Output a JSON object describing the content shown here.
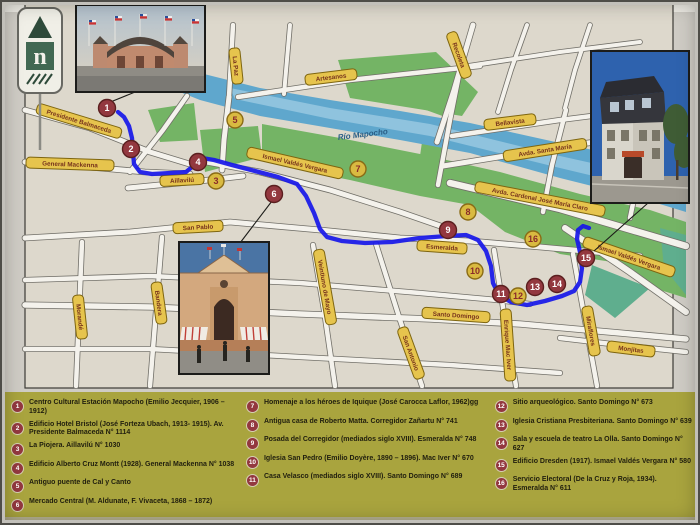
{
  "title": "Mapa turístico del centro de Santiago - ruta patrimonial",
  "logo": {
    "letter": "n"
  },
  "colors": {
    "route_blue": "#1818e8",
    "river_blue": "#5fa7cd",
    "river_light": "#8fc3de",
    "park_green": "#74b465",
    "teal_green": "#5fae8e",
    "label_fill": "#e6c44d",
    "label_border": "#7e650f",
    "label_text": "#77331c",
    "marker_red": "#93383f",
    "marker_yellow": "#d9ba41",
    "legend_bg": "#a9a43e",
    "paper": "#ddd8cc",
    "street": "#f4f2ec"
  },
  "map": {
    "river_label": {
      "text": "Río Mapocho",
      "x": 363,
      "y": 137,
      "rot": -7
    },
    "street_labels": [
      {
        "text": "Presidente Balmaceda",
        "x": 79,
        "y": 121,
        "rot": 17,
        "w": 88
      },
      {
        "text": "General Mackenna",
        "x": 70,
        "y": 164,
        "rot": 2,
        "w": 88
      },
      {
        "text": "Aillavilú",
        "x": 182,
        "y": 180,
        "rot": -3,
        "w": 44
      },
      {
        "text": "La Paz",
        "x": 236,
        "y": 66,
        "rot": 84,
        "w": 36
      },
      {
        "text": "Artesanos",
        "x": 331,
        "y": 77,
        "rot": -7,
        "w": 52
      },
      {
        "text": "Recoleta",
        "x": 459,
        "y": 55,
        "rot": 70,
        "w": 48
      },
      {
        "text": "Bellavista",
        "x": 510,
        "y": 122,
        "rot": -7,
        "w": 52
      },
      {
        "text": "Avda. Santa María",
        "x": 545,
        "y": 150,
        "rot": -9,
        "w": 84
      },
      {
        "text": "Ismael Valdés Vergara",
        "x": 295,
        "y": 163,
        "rot": 13,
        "w": 98
      },
      {
        "text": "Avda. Cardenal José María Claro",
        "x": 540,
        "y": 199,
        "rot": 11,
        "w": 132
      },
      {
        "text": "Esmeralda",
        "x": 442,
        "y": 247,
        "rot": 4,
        "w": 50
      },
      {
        "text": "Ismael Valdés Vergara",
        "x": 629,
        "y": 257,
        "rot": 19,
        "w": 96
      },
      {
        "text": "Santo Domingo",
        "x": 456,
        "y": 315,
        "rot": 4,
        "w": 68
      },
      {
        "text": "Monjitas",
        "x": 631,
        "y": 349,
        "rot": 7,
        "w": 48
      },
      {
        "text": "San Pablo",
        "x": 198,
        "y": 227,
        "rot": -3,
        "w": 50
      },
      {
        "text": "Morandé",
        "x": 80,
        "y": 317,
        "rot": 84,
        "w": 44
      },
      {
        "text": "Bandera",
        "x": 159,
        "y": 303,
        "rot": 82,
        "w": 42
      },
      {
        "text": "Veintiuno de Mayo",
        "x": 325,
        "y": 287,
        "rot": 80,
        "w": 76
      },
      {
        "text": "San Antonio",
        "x": 411,
        "y": 353,
        "rot": 70,
        "w": 54
      },
      {
        "text": "Enrique Mac Iver",
        "x": 508,
        "y": 345,
        "rot": 86,
        "w": 72
      },
      {
        "text": "Miraflores",
        "x": 591,
        "y": 331,
        "rot": 80,
        "w": 50
      }
    ],
    "streets": [
      {
        "pts": "25,110 90,128 150,152 196,166",
        "w": 5
      },
      {
        "pts": "25,162 100,168 145,172 190,174",
        "w": 5
      },
      {
        "pts": "128,188 200,181 243,176",
        "w": 5
      },
      {
        "pts": "130,172 163,130 187,96",
        "w": 4.5
      },
      {
        "pts": "25,238 130,232 230,222 320,230 400,238 470,241 540,247 640,256",
        "w": 5
      },
      {
        "pts": "25,280 150,276 300,283 420,293 497,300 530,304",
        "w": 4.5
      },
      {
        "pts": "25,305 150,307 300,314 430,319 520,324 620,333 686,339",
        "w": 5.5
      },
      {
        "pts": "560,338 620,345 686,352",
        "w": 4.5
      },
      {
        "pts": "25,349 150,349 300,357 450,365 560,373",
        "w": 4.5
      },
      {
        "pts": "82,242 76,386",
        "w": 4.5
      },
      {
        "pts": "162,237 150,386",
        "w": 4.5
      },
      {
        "pts": "313,245 324,310 335,386",
        "w": 4.5
      },
      {
        "pts": "376,244 400,320 422,386",
        "w": 4.5
      },
      {
        "pts": "494,250 505,320 516,386",
        "w": 4.5
      },
      {
        "pts": "573,254 585,320 597,386",
        "w": 4.5
      },
      {
        "pts": "196,160 260,172 330,190 400,212 452,230",
        "w": 5
      },
      {
        "pts": "565,228 630,272 686,312",
        "w": 6
      },
      {
        "pts": "450,183 560,209 686,246",
        "w": 6.5
      },
      {
        "pts": "238,97 350,80 480,66",
        "w": 4.5
      },
      {
        "pts": "233,25 229,97",
        "w": 4.5
      },
      {
        "pts": "229,97 224,140 222,170",
        "w": 5
      },
      {
        "pts": "290,25 284,94",
        "w": 4
      },
      {
        "pts": "462,60 450,120 438,185",
        "w": 4.5
      },
      {
        "pts": "473,25 454,90 437,142",
        "w": 5
      },
      {
        "pts": "452,136 560,120 686,104",
        "w": 4.5
      },
      {
        "pts": "443,166 560,147 686,129",
        "w": 5
      },
      {
        "pts": "566,110 552,165 543,212",
        "w": 4.5
      },
      {
        "pts": "655,113 640,170 630,218",
        "w": 4.5
      },
      {
        "pts": "527,25 511,70 498,112",
        "w": 4
      },
      {
        "pts": "590,25 575,70 565,108",
        "w": 4
      },
      {
        "pts": "468,66 560,52 640,42",
        "w": 4
      }
    ],
    "route_points": "118,112 124,117 129,126 132,138 133,152 134,164 140,172 152,174 170,173 186,172 192,167 195,160 202,158 214,160 232,165 255,171 278,177 297,184 306,196 314,213 320,229 327,237 342,241 365,243 392,242 420,238 447,236 466,235 478,240 486,251 491,266 493,283 499,295 511,302 527,305 545,301 562,296 574,291 580,282 582,268 580,252 577,239 578,230 583,226 589,228",
    "connectors": [
      {
        "x1": 108,
        "y1": 103,
        "x2": 140,
        "y2": 90
      },
      {
        "x1": 272,
        "y1": 201,
        "x2": 240,
        "y2": 243
      },
      {
        "x1": 648,
        "y1": 203,
        "x2": 594,
        "y2": 251
      }
    ],
    "markers": [
      {
        "num": "1",
        "x": 107,
        "y": 108,
        "type": "red"
      },
      {
        "num": "2",
        "x": 131,
        "y": 149,
        "type": "red"
      },
      {
        "num": "3",
        "x": 216,
        "y": 181,
        "type": "yellow"
      },
      {
        "num": "4",
        "x": 198,
        "y": 162,
        "type": "red"
      },
      {
        "num": "5",
        "x": 235,
        "y": 120,
        "type": "yellow"
      },
      {
        "num": "6",
        "x": 274,
        "y": 194,
        "type": "red"
      },
      {
        "num": "7",
        "x": 358,
        "y": 169,
        "type": "yellow"
      },
      {
        "num": "8",
        "x": 468,
        "y": 212,
        "type": "yellow"
      },
      {
        "num": "9",
        "x": 448,
        "y": 230,
        "type": "red"
      },
      {
        "num": "10",
        "x": 475,
        "y": 271,
        "type": "yellow"
      },
      {
        "num": "11",
        "x": 501,
        "y": 294,
        "type": "red"
      },
      {
        "num": "12",
        "x": 518,
        "y": 296,
        "type": "yellow"
      },
      {
        "num": "13",
        "x": 535,
        "y": 287,
        "type": "red"
      },
      {
        "num": "14",
        "x": 557,
        "y": 284,
        "type": "red"
      },
      {
        "num": "15",
        "x": 586,
        "y": 258,
        "type": "red"
      },
      {
        "num": "16",
        "x": 533,
        "y": 239,
        "type": "yellow"
      }
    ]
  },
  "legend": {
    "columns": [
      [
        {
          "num": "1",
          "text": "Centro Cultural Estación Mapocho (Emilio Jecquier, 1906 – 1912)"
        },
        {
          "num": "2",
          "text": "Edificio Hotel Bristol (José Forteza Ubach, 1913- 1915). Av. Presidente Balmaceda N° 1114"
        },
        {
          "num": "3",
          "text": "La Piojera. Aillavilú N° 1030"
        },
        {
          "num": "4",
          "text": "Edificio Alberto Cruz Montt (1928). General Mackenna N° 1038"
        },
        {
          "num": "5",
          "text": "Antiguo puente de Cal y Canto"
        },
        {
          "num": "6",
          "text": "Mercado Central (M. Aldunate, F. Vivaceta, 1868 – 1872)"
        }
      ],
      [
        {
          "num": "7",
          "text": "Homenaje a los héroes de Iquique (José Carocca Laflor, 1962)gg"
        },
        {
          "num": "8",
          "text": "Antigua casa de Roberto Matta. Corregidor Zañartu N° 741"
        },
        {
          "num": "9",
          "text": "Posada del Corregidor (mediados siglo XVIII). Esmeralda N° 748"
        },
        {
          "num": "10",
          "text": "Iglesia San Pedro (Emilio Doyère, 1890 – 1896). Mac Iver N° 670"
        },
        {
          "num": "11",
          "text": "Casa Velasco (mediados siglo XVIII). Santo Domingo N° 689"
        }
      ],
      [
        {
          "num": "12",
          "text": "Sitio arqueológico. Santo Domingo N° 673"
        },
        {
          "num": "13",
          "text": "Iglesia Cristiana Presbiteriana. Santo Domingo N° 639"
        },
        {
          "num": "14",
          "text": "Sala y escuela de teatro La Olla. Santo Domingo N° 627"
        },
        {
          "num": "15",
          "text": "Edificio Dresden (1917). Ismael Valdés Vergara N° 580"
        },
        {
          "num": "16",
          "text": "Servicio Electoral (De la Cruz y Roja, 1934). Esmeralda N° 611"
        }
      ]
    ]
  }
}
